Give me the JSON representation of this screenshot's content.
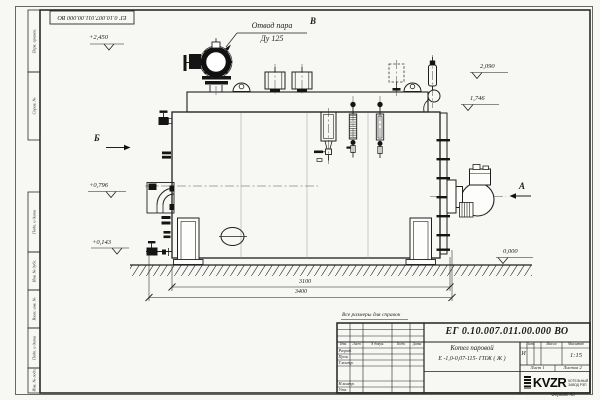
{
  "frame": {
    "margin_labels_top": [
      "Перв. примен.",
      "Справ. №"
    ],
    "margin_labels_bottom": [
      "Подп. и дата",
      "Инв. № дубл.",
      "Взам. инв. №",
      "Подп. и дата",
      "Инв. № подл."
    ],
    "format_note": "Формат А3"
  },
  "drawing": {
    "callout_line1": "Отвод пара",
    "callout_line2": "Ду 125",
    "view_b": "Б",
    "view_v": "В",
    "view_a": "А",
    "elev_2450": "+2,450",
    "elev_2090": "2,090",
    "elev_1746": "1,746",
    "elev_0796": "+0,796",
    "elev_0143": "+0,143",
    "elev_0000": "0,000",
    "dim_inner": "3100",
    "dim_outer": "3400"
  },
  "title_block": {
    "note": "Все размеры для справок",
    "doc_number": "ЕГ 0.10.007.011.00.000  ВО",
    "product_name": "Котел паровой",
    "designation": "Е -1,0-0,07-115- ГПЖ ( Ж )",
    "col_headers": [
      "Изм.",
      "Лист",
      "N докум.",
      "Подп.",
      "Дата"
    ],
    "row_labels": [
      "Разраб.",
      "Пров.",
      "Т.контр.",
      "Н.контр.",
      "Утв."
    ],
    "lit_header": "Лит.",
    "mass_header": "Масса",
    "scale_header": "Масштаб",
    "lit_value": "И",
    "scale_value": "1:15",
    "sheet_info": "Лист 1",
    "sheets_info": "Листов 2",
    "logo_text": "KVZR",
    "logo_sub": [
      "КОТЕЛЬНЫЙ",
      "ЗАВОД РЭП"
    ]
  }
}
